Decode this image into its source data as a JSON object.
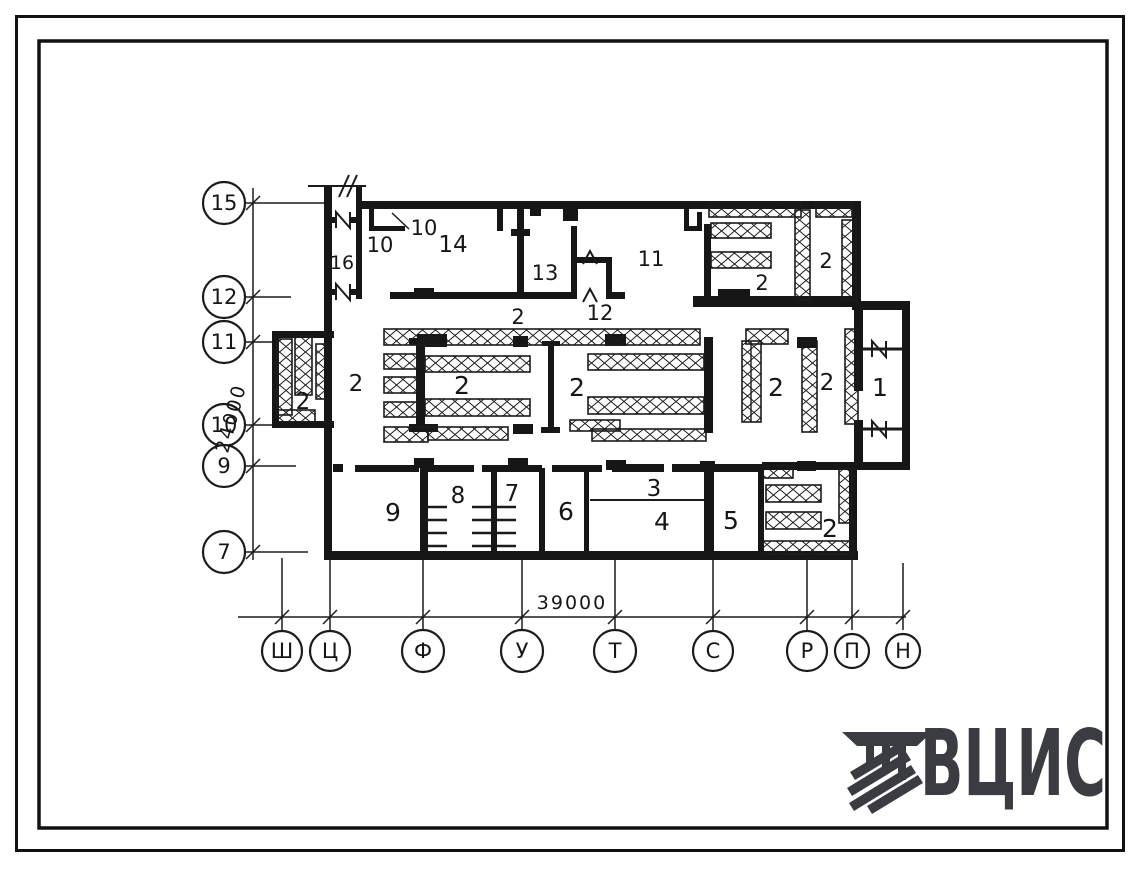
{
  "sheet": {
    "type": "architectural floor plan",
    "ink_color": "#161616",
    "logo_color": "#3b3b42"
  },
  "plan": {
    "rooms": [
      "16",
      "10",
      "10",
      "14",
      "13",
      "12",
      "11",
      "2",
      "2",
      "2",
      "2",
      "2",
      "2",
      "2",
      "2",
      "2",
      "1",
      "9",
      "8",
      "7",
      "6",
      "3",
      "4",
      "5",
      "2"
    ],
    "row_markers": [
      "15",
      "12",
      "11",
      "10",
      "9",
      "7"
    ],
    "col_markers": [
      "Ш",
      "Ц",
      "Ф",
      "У",
      "Т",
      "С",
      "Р",
      "П",
      "Н"
    ],
    "dims": {
      "vertical": "24000",
      "horizontal": "39000"
    }
  },
  "logo": {
    "text": "ВЦИС"
  }
}
